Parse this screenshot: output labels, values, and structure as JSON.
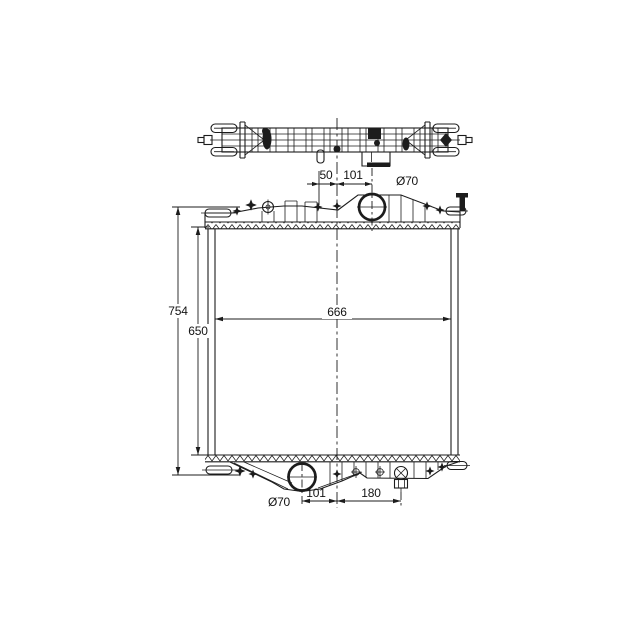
{
  "drawing": {
    "kind": "radiator-technical-drawing",
    "views": {
      "top_view": "radiator plan view (top tank seen from above)",
      "front_view": "radiator front elevation with top tank, core and bottom tank"
    },
    "colors": {
      "background": "#ffffff",
      "line": "#1c1c1c"
    },
    "dimensions": {
      "top": {
        "clip_offset": "50",
        "inlet_offset": "101",
        "inlet_diameter": "Ø70"
      },
      "left": {
        "overall_height": "754",
        "core_height": "650"
      },
      "core": {
        "width": "666"
      },
      "bottom": {
        "outlet_diameter": "Ø70",
        "outlet_offset": "101",
        "drain_offset": "180"
      }
    }
  }
}
